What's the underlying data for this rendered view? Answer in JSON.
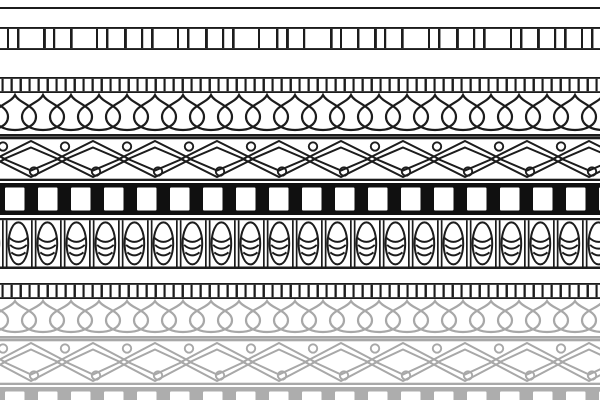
{
  "canvas": {
    "width": 600,
    "height": 400,
    "background": "#ffffff"
  },
  "palette": {
    "ink_black": "#1c1c1c",
    "fill_black": "#101010",
    "ink_gray": "#a8a8a8",
    "fill_gray": "#adadad",
    "paper": "#ffffff"
  },
  "bands": [
    {
      "name": "top-rule",
      "motif": "thin-horizontal-rule",
      "type": "hline",
      "color": "#1c1c1c",
      "top": 7,
      "height": 2
    },
    {
      "name": "tally-rail",
      "motif": "irregular-vertical-tally-marks-between-rails",
      "type": "tally",
      "color": "#1c1c1c",
      "top": 27,
      "height": 23,
      "tick_positions": [
        7,
        17,
        43,
        53,
        70,
        96,
        106,
        124,
        141,
        151,
        177,
        187,
        205,
        222,
        232,
        258,
        276,
        286,
        303,
        330,
        340,
        357,
        374,
        384,
        401,
        428,
        438,
        456,
        473,
        483,
        510,
        520,
        537,
        554,
        564,
        581,
        591
      ]
    },
    {
      "name": "dentil-upper",
      "motif": "dense-dentil-ticks",
      "type": "dentil",
      "color": "#1c1c1c",
      "top": 77,
      "height": 16,
      "pitch": 9
    },
    {
      "name": "petal-row-upper",
      "motif": "overlapping-lotus-petal-drops",
      "type": "drops",
      "color": "#1c1c1c",
      "top": 93,
      "height": 44,
      "pitch": 28,
      "half_width": 21
    },
    {
      "name": "trellis-upper",
      "motif": "interlocking-double-diamonds-with-rings",
      "type": "lattice",
      "color": "#1c1c1c",
      "top": 137,
      "height": 44,
      "pitch": 62
    },
    {
      "name": "block-row-black",
      "motif": "black-band-with-white-blocks",
      "type": "squares",
      "color": "#101010",
      "top": 183,
      "height": 32,
      "pitch": 33,
      "square_start": 5,
      "square_top": 4.5,
      "square_width": 19.5,
      "square_height": 23
    },
    {
      "name": "husk-row",
      "motif": "egg-husk-ovals-in-cells",
      "type": "ovals",
      "color": "#1c1c1c",
      "top": 218,
      "height": 51,
      "pitch": 29
    },
    {
      "name": "dentil-lower",
      "motif": "dense-dentil-ticks",
      "type": "dentil",
      "color": "#1c1c1c",
      "top": 283,
      "height": 16,
      "pitch": 9
    },
    {
      "name": "petal-row-faded",
      "motif": "overlapping-lotus-petal-drops-faded",
      "type": "drops",
      "color": "#a8a8a8",
      "top": 299,
      "height": 40,
      "pitch": 28,
      "half_width": 21
    },
    {
      "name": "trellis-faded",
      "motif": "interlocking-double-diamonds-with-rings-faded",
      "type": "lattice",
      "color": "#a8a8a8",
      "top": 339,
      "height": 46,
      "pitch": 62
    },
    {
      "name": "block-row-faded",
      "motif": "gray-band-with-white-blocks-cropped",
      "type": "squares",
      "color": "#adadad",
      "top": 387,
      "height": 13,
      "pitch": 33,
      "square_start": 5,
      "square_top": 4.5,
      "square_width": 19.5,
      "square_height": 12
    }
  ]
}
